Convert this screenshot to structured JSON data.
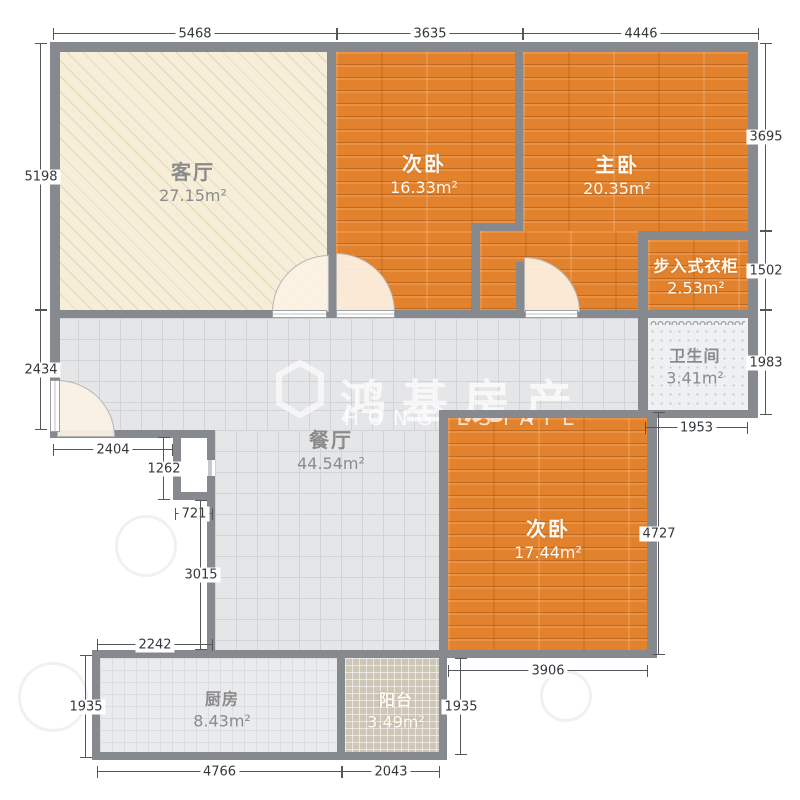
{
  "plan": {
    "title": "apartment floor plan",
    "wall_color": "#868a8e",
    "wood_color": "#e2822c",
    "living_color": "#f6eed8",
    "tile_color": "#e5e6e8"
  },
  "watermark": {
    "cjk": "鸿基房产",
    "latin": "HONG ESTATE"
  },
  "rooms": [
    {
      "name": "客厅",
      "area": "27.15m²",
      "cx": 193,
      "cy": 183,
      "style": "lbl-gray"
    },
    {
      "name": "次卧",
      "area": "16.33m²",
      "cx": 424,
      "cy": 175,
      "style": "lbl-white"
    },
    {
      "name": "主卧",
      "area": "20.35m²",
      "cx": 617,
      "cy": 176,
      "style": "lbl-white"
    },
    {
      "name": "步入式衣柜",
      "area": "2.53m²",
      "cx": 696,
      "cy": 278,
      "style": "lbl-white lbl-sm"
    },
    {
      "name": "卫生间",
      "area": "3.41m²",
      "cx": 695,
      "cy": 368,
      "style": "lbl-gray lbl-sm"
    },
    {
      "name": "餐厅",
      "area": "44.54m²",
      "cx": 331,
      "cy": 451,
      "style": "lbl-gray"
    },
    {
      "name": "次卧",
      "area": "17.44m²",
      "cx": 548,
      "cy": 540,
      "style": "lbl-white"
    },
    {
      "name": "厨房",
      "area": "8.43m²",
      "cx": 222,
      "cy": 711,
      "style": "lbl-gray lbl-sm"
    },
    {
      "name": "阳台",
      "area": "3.49m²",
      "cx": 396,
      "cy": 712,
      "style": "lbl-white lbl-sm"
    }
  ],
  "dimensions": [
    {
      "value": "5468",
      "type": "h",
      "x": 53,
      "y": 33,
      "len": 284
    },
    {
      "value": "3635",
      "type": "h",
      "x": 337,
      "y": 33,
      "len": 186
    },
    {
      "value": "4446",
      "type": "h",
      "x": 523,
      "y": 33,
      "len": 236
    },
    {
      "value": "5198",
      "type": "v",
      "x": 40,
      "y": 43,
      "len": 267
    },
    {
      "value": "2434",
      "type": "v",
      "x": 40,
      "y": 310,
      "len": 120
    },
    {
      "value": "3695",
      "type": "v",
      "x": 765,
      "y": 43,
      "len": 188
    },
    {
      "value": "1502",
      "type": "v",
      "x": 765,
      "y": 231,
      "len": 79
    },
    {
      "value": "1983",
      "type": "v",
      "x": 765,
      "y": 310,
      "len": 105
    },
    {
      "value": "2404",
      "type": "h",
      "x": 53,
      "y": 449,
      "len": 120
    },
    {
      "value": "1262",
      "type": "v",
      "x": 163,
      "y": 437,
      "len": 63
    },
    {
      "value": "721",
      "type": "h",
      "x": 175,
      "y": 513,
      "len": 38
    },
    {
      "value": "3015",
      "type": "v",
      "x": 200,
      "y": 500,
      "len": 150
    },
    {
      "value": "2242",
      "type": "h",
      "x": 97,
      "y": 644,
      "len": 116
    },
    {
      "value": "1935",
      "type": "v",
      "x": 85,
      "y": 655,
      "len": 103
    },
    {
      "value": "4766",
      "type": "h",
      "x": 97,
      "y": 771,
      "len": 245
    },
    {
      "value": "2043",
      "type": "h",
      "x": 342,
      "y": 771,
      "len": 98
    },
    {
      "value": "1935",
      "type": "v",
      "x": 460,
      "y": 658,
      "len": 97
    },
    {
      "value": "3906",
      "type": "h",
      "x": 448,
      "y": 670,
      "len": 200
    },
    {
      "value": "4727",
      "type": "v",
      "x": 658,
      "y": 412,
      "len": 243
    },
    {
      "value": "1953",
      "type": "h",
      "x": 645,
      "y": 427,
      "len": 103
    }
  ]
}
